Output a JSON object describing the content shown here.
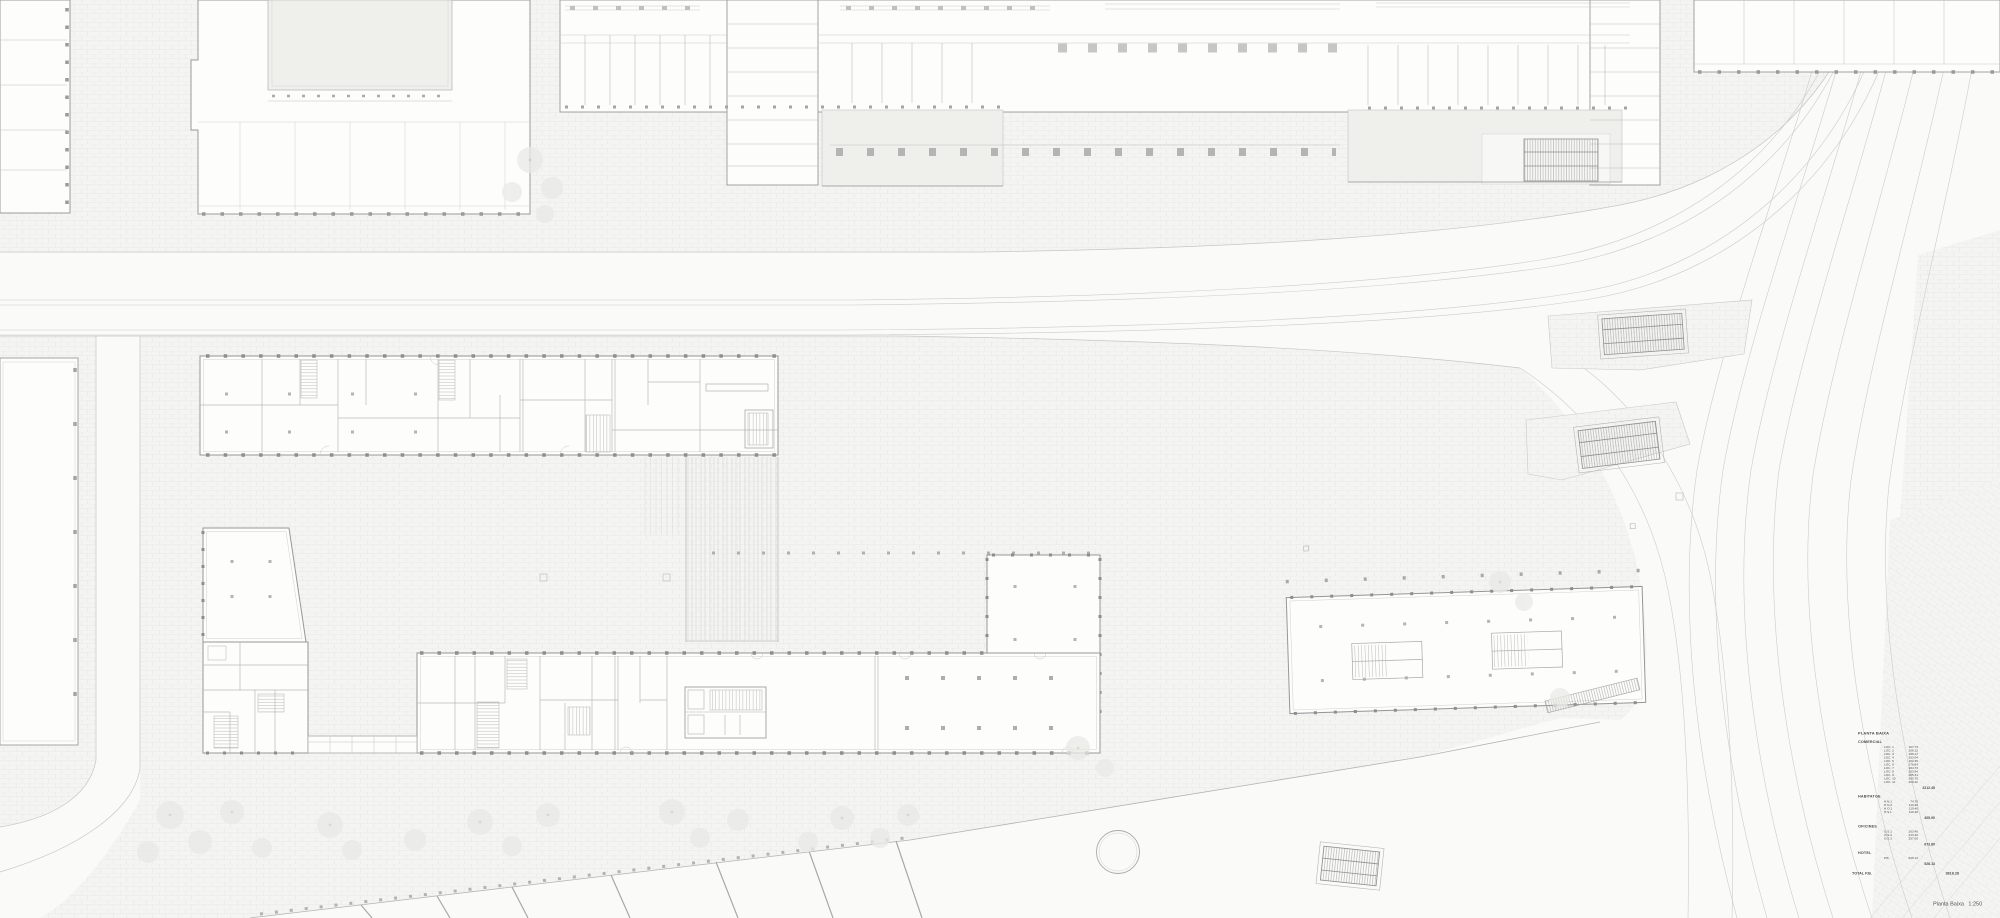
{
  "drawing": {
    "caption": {
      "name": "Planta Baixa",
      "scale": "1:250"
    }
  },
  "legend": {
    "title": "PLANTA BAIXA",
    "sections": [
      {
        "name": "COMERCIAL",
        "rows": [
          {
            "label": "LOC. 1",
            "value": "107.73"
          },
          {
            "label": "LOC. 2",
            "value": "206.12"
          },
          {
            "label": "LOC. 3",
            "value": "196.17"
          },
          {
            "label": "LOC. 4",
            "value": "263.04"
          },
          {
            "label": "LOC. 5",
            "value": "102.45"
          },
          {
            "label": "LOC. 6",
            "value": "176.84"
          },
          {
            "label": "LOC. 7",
            "value": "184.73"
          },
          {
            "label": "LOC. 8",
            "value": "203.94"
          },
          {
            "label": "LOC. 9",
            "value": "205.31"
          },
          {
            "label": "LOC. 10",
            "value": "305.70"
          },
          {
            "label": "LOC. 11",
            "value": "260.42"
          }
        ],
        "subtotal": "2212.45"
      },
      {
        "name": "HABITATGE",
        "rows": [
          {
            "label": "H.N.1",
            "value": "74.70"
          },
          {
            "label": "H.N.2",
            "value": "110.40"
          },
          {
            "label": "H.O.1",
            "value": "110.40"
          },
          {
            "label": "H.S.1",
            "value": "110.40"
          }
        ],
        "subtotal": "405.90"
      },
      {
        "name": "OFICINES",
        "rows": [
          {
            "label": "O.S.1",
            "value": "203.40"
          },
          {
            "label": "O.S.2",
            "value": "213.40"
          },
          {
            "label": "O.S.3",
            "value": "257.00"
          }
        ],
        "subtotal": "673.80"
      },
      {
        "name": "HOTEL",
        "rows": [
          {
            "label": "P.B.",
            "value": "526.13"
          }
        ],
        "subtotal": "526.13"
      }
    ],
    "total": {
      "label": "TOTAL P.B.",
      "value": "3818.28"
    }
  },
  "colors": {
    "paper": "#fafaf8",
    "paving": "#f4f4f2",
    "paving_line": "#e9e9e6",
    "building_fill": "#fdfdfc",
    "building_stroke": "#9a9a98",
    "interior_line": "#c2c2c0",
    "courtyard": "#efefec",
    "track_line": "#ccccca",
    "text": "#4b4b49"
  }
}
